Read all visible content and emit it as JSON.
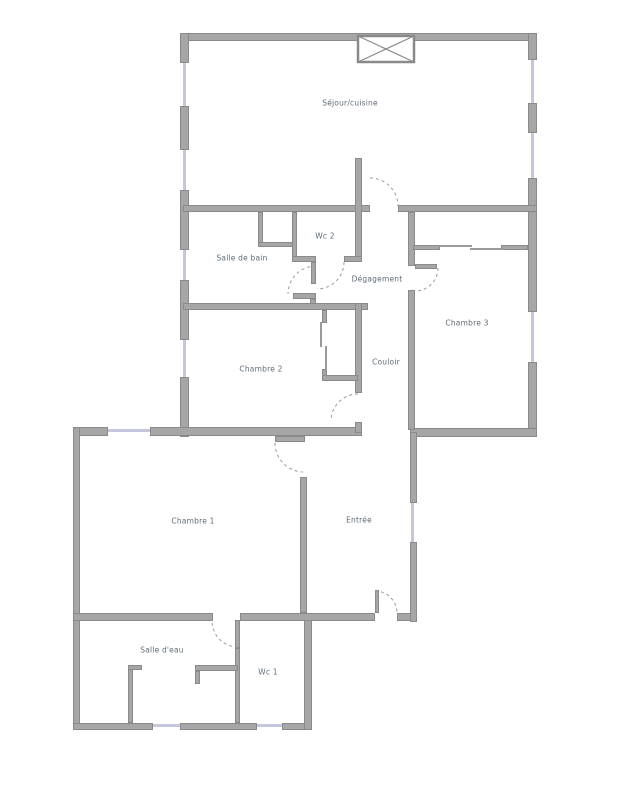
{
  "plan": {
    "type": "apartment-floor-plan",
    "colors": {
      "wall": "#a6a6a6",
      "wall_border": "#8a8a8a",
      "window": "#c3c7e0",
      "door_arc": "#9a9a9a",
      "label_text": "#5f6b76",
      "background": "#ffffff"
    },
    "rooms": {
      "sejour": {
        "label": "Séjour/cuisine"
      },
      "wc2": {
        "label": "Wc 2"
      },
      "salle_de_bain": {
        "label": "Salle de bain"
      },
      "degagement": {
        "label": "Dégagement"
      },
      "chambre3": {
        "label": "Chambre 3"
      },
      "chambre2": {
        "label": "Chambre 2"
      },
      "couloir": {
        "label": "Couloir"
      },
      "chambre1": {
        "label": "Chambre 1"
      },
      "entree": {
        "label": "Entrée"
      },
      "salle_deau": {
        "label": "Salle d'eau"
      },
      "wc1": {
        "label": "Wc 1"
      }
    }
  }
}
